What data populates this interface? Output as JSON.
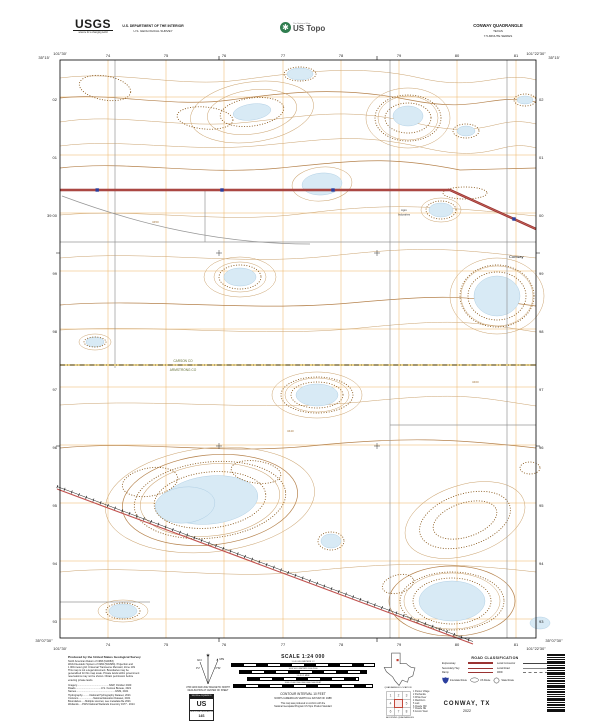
{
  "header": {
    "usgs_logo": "USGS",
    "usgs_tagline": "science for a changing world",
    "dept_line1": "U.S. DEPARTMENT OF THE INTERIOR",
    "dept_line2": "U.S. GEOLOGICAL SURVEY",
    "ustopo_small": "The National Map",
    "ustopo_brand": "US Topo",
    "quad_title": "CONWAY QUADRANGLE",
    "quad_state": "TEXAS",
    "quad_series": "7.5-MINUTE SERIES"
  },
  "map": {
    "corner": {
      "tl_lon": "101°30'",
      "tl_lat": "35°15'",
      "tr_lon": "101°22'30\"",
      "tr_lat": "35°15'",
      "bl_lat": "35°07'30\"",
      "bl_lon": "101°30'",
      "br_lat": "35°07'30\"",
      "br_lon": "101°22'30\""
    },
    "top_eastings": [
      "74",
      "75",
      "76",
      "77",
      "78",
      "79",
      "80",
      "81"
    ],
    "bottom_eastings": [
      "74",
      "75",
      "76",
      "77",
      "78",
      "79",
      "80",
      "81"
    ],
    "left_northings": [
      "02",
      "01",
      "39 00",
      "99",
      "98",
      "97",
      "96",
      "95",
      "94",
      "93"
    ],
    "right_northings": [
      "02",
      "01",
      "00",
      "99",
      "98",
      "97",
      "96",
      "95",
      "94",
      "93"
    ],
    "labels": {
      "town": "Conway",
      "facility_line1": "Agro",
      "facility_line2": "Industries",
      "county_north": "CARSON CO",
      "county_south": "ARMSTRONG CO",
      "spot1": "3450",
      "spot2": "3440",
      "spot3": "3460"
    }
  },
  "footer": {
    "produced_title": "Produced by the United States Geological Survey",
    "body": [
      "North American Datum of 1983 (NAD83)",
      "World Geodetic System of 1984 (WGS84). Projection and",
      "1 000-meter grid: Universal Transverse Mercator, Zone 14S",
      "This map is not a legal document. Boundaries may be",
      "generalized for this map scale. Private lands within government",
      "reservations may not be shown. Obtain permission before",
      "entering private lands."
    ],
    "sources": [
      "Imagery.............................................NAIP, October 2020",
      "Roads....................................U.S. Census Bureau, 2021",
      "Names.......................................................GNIS, 2021",
      "Hydrography..........National Hydrography Dataset, 2021",
      "Contours.....................National Elevation Dataset, 2021",
      "Boundaries......Multiple sources; see metadata file 2021",
      "Wetlands.....FWS National Wetlands Inventory 1977 - 2014"
    ],
    "declination": {
      "gn_label": "GN",
      "mn_label": "MN",
      "gn_value": "0°2'",
      "mn_value": "6°52'",
      "caption1": "UTM GRID AND 2022 MAGNETIC NORTH",
      "caption2": "DECLINATION AT CENTER OF SHEET"
    },
    "mgrs": {
      "header": "100,000-m SQUARE ID",
      "square_id": "US",
      "gzd_label": "GRID ZONE DESIGNATION",
      "gzd": "14S"
    },
    "scale": {
      "title": "SCALE 1:24 000",
      "bar_captions": [
        "1   0.5   0   KILOMETERS   1   2",
        "1000   500   0   METERS   1000   2000",
        "1   0.5   0   1 MILE",
        "1000   0   1000   2000   3000   4000   5000   FEET"
      ],
      "contour_line1": "CONTOUR INTERVAL 10 FEET",
      "contour_line2": "NORTH AMERICAN VERTICAL DATUM OF 1988",
      "conform1": "This map was produced to conform with the",
      "conform2": "National Geospatial Program US Topo Product Standard"
    },
    "quad_location_caption": "QUADRANGLE LOCATION",
    "adjoining_caption": "ADJOINING QUADRANGLES",
    "adjoining": [
      "1  Pantex Village",
      "2  Panhandle",
      "3  White Deer",
      "4  Washburn",
      "5  Lark",
      "6  Claude NW",
      "7  Claude NE",
      "8  Groom West"
    ],
    "road_class": {
      "title": "ROAD CLASSIFICATION",
      "left_rows": [
        "Expressway",
        "Secondary Hwy",
        "Ramp"
      ],
      "right_rows": [
        "Local Connector",
        "Local Road",
        "4WD"
      ],
      "shield_rows": [
        "Interstate Route",
        "US Route",
        "State Route"
      ]
    },
    "title_block": {
      "name": "CONWAY, TX",
      "year": "2022"
    }
  },
  "colors": {
    "contour": "#CBA36F",
    "depression": "#8A5A1E",
    "water": "#D8EAF5",
    "utm_grid": "#E9A13B",
    "interstate": "#9A3332",
    "interchange_marker": "#2B3F9E",
    "county_road": "#E7C766",
    "railroad": "#222222"
  }
}
